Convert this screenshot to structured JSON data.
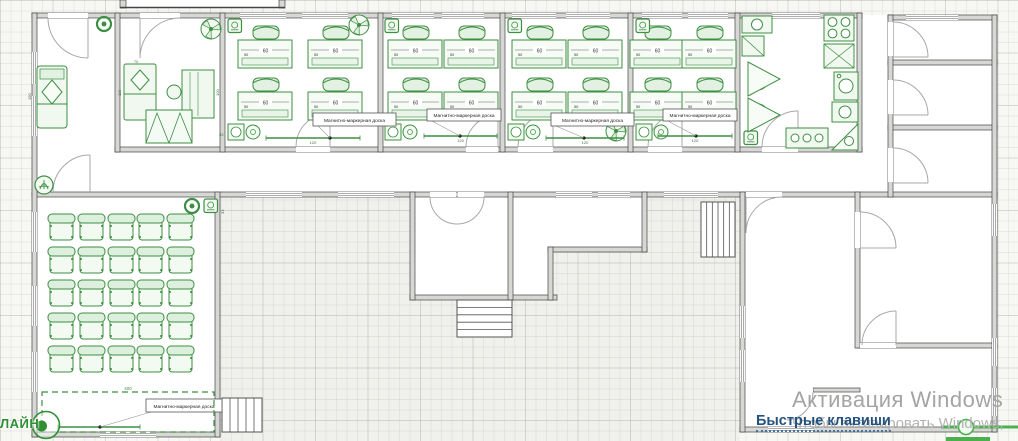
{
  "app": {
    "watermark_line1": "Активация Windows",
    "watermark_line2": "Чтобы активировать Windows,",
    "shortcut_link": "Быстрые клавиши",
    "logo_text": "ЛАЙН"
  },
  "labels": {
    "board": "Магнитно-маркерная доска"
  },
  "dims": {
    "desk_w": "60",
    "desk_d": "50",
    "offset": "33",
    "board_w": "120",
    "stage_w": "400",
    "bed_len": "110",
    "sofa_len": "190",
    "pillow": "70",
    "desk_len": "100"
  },
  "colors": {
    "furniture_green": "#3e8f42",
    "selection_green": "#4caf50",
    "wall_gray": "#d7d7d5",
    "link_blue": "#24527f",
    "watermark_gray": "#a4a4a4"
  },
  "plan": {
    "desks": [
      [
        238,
        26
      ],
      [
        308,
        26
      ],
      [
        238,
        78
      ],
      [
        308,
        78
      ],
      [
        388,
        26
      ],
      [
        444,
        26
      ],
      [
        388,
        78
      ],
      [
        444,
        78
      ],
      [
        512,
        26
      ],
      [
        568,
        26
      ],
      [
        512,
        78
      ],
      [
        568,
        78
      ],
      [
        630,
        26
      ],
      [
        682,
        26
      ],
      [
        630,
        78
      ],
      [
        682,
        78
      ]
    ],
    "aud_chairs": {
      "xs": [
        48,
        78,
        108,
        137,
        167
      ],
      "ys": [
        214,
        247,
        280,
        313,
        346
      ]
    },
    "boards": [
      {
        "x1": 266,
        "x2": 360,
        "y": 138,
        "dot": 330,
        "box": [
          313,
          113,
          83,
          13
        ],
        "dim": true
      },
      {
        "x1": 424,
        "x2": 497,
        "y": 136,
        "dot": 460,
        "box": [
          427,
          109,
          74,
          12
        ],
        "dim": true
      },
      {
        "x1": 546,
        "x2": 624,
        "y": 138,
        "dot": 584,
        "box": [
          551,
          113,
          83,
          13
        ],
        "dim": true
      },
      {
        "x1": 658,
        "x2": 732,
        "y": 136,
        "dot": 696,
        "box": [
          663,
          109,
          74,
          12
        ],
        "dim": true
      },
      {
        "x1": 58,
        "x2": 140,
        "y": 427,
        "dot": 100,
        "box": [
          146,
          399,
          76,
          13
        ],
        "dim": false
      }
    ],
    "fans": [
      [
        359,
        25
      ],
      [
        616,
        131
      ],
      [
        211,
        29
      ],
      [
        758,
        80
      ],
      [
        758,
        114
      ]
    ],
    "rings": [
      [
        104,
        24
      ],
      [
        192,
        206
      ]
    ],
    "flower": [
      44,
      185
    ],
    "acs": [
      [
        228,
        19
      ],
      [
        385,
        19
      ],
      [
        508,
        19
      ],
      [
        636,
        19
      ],
      [
        204,
        199
      ],
      [
        744,
        131
      ]
    ],
    "sinks": [
      [
        228,
        124
      ],
      [
        385,
        124
      ],
      [
        508,
        124
      ],
      [
        636,
        124
      ]
    ],
    "windows_h": [
      [
        240,
        13,
        46
      ],
      [
        302,
        13,
        46
      ],
      [
        392,
        13,
        42
      ],
      [
        442,
        13,
        42
      ],
      [
        512,
        13,
        44
      ],
      [
        566,
        13,
        44
      ],
      [
        642,
        13,
        40
      ],
      [
        688,
        13,
        40
      ],
      [
        772,
        13,
        48
      ],
      [
        906,
        15,
        52
      ],
      [
        246,
        192,
        56
      ],
      [
        338,
        192,
        56
      ],
      [
        556,
        192,
        36
      ],
      [
        598,
        192,
        32
      ],
      [
        664,
        192,
        54
      ],
      [
        100,
        432,
        56
      ],
      [
        768,
        427,
        46
      ]
    ],
    "windows_v": [
      [
        32,
        52,
        32
      ],
      [
        32,
        96,
        40
      ],
      [
        32,
        212,
        40
      ],
      [
        32,
        286,
        40
      ],
      [
        32,
        352,
        40
      ],
      [
        740,
        306,
        32
      ],
      [
        740,
        350,
        32
      ],
      [
        992,
        204,
        32
      ],
      [
        992,
        338,
        28
      ],
      [
        992,
        388,
        28
      ]
    ],
    "stairs": [
      [
        457,
        300,
        55,
        37,
        "h",
        4
      ],
      [
        701,
        202,
        34,
        55,
        "v",
        5
      ],
      [
        222,
        398,
        40,
        34,
        "v",
        4
      ]
    ]
  }
}
